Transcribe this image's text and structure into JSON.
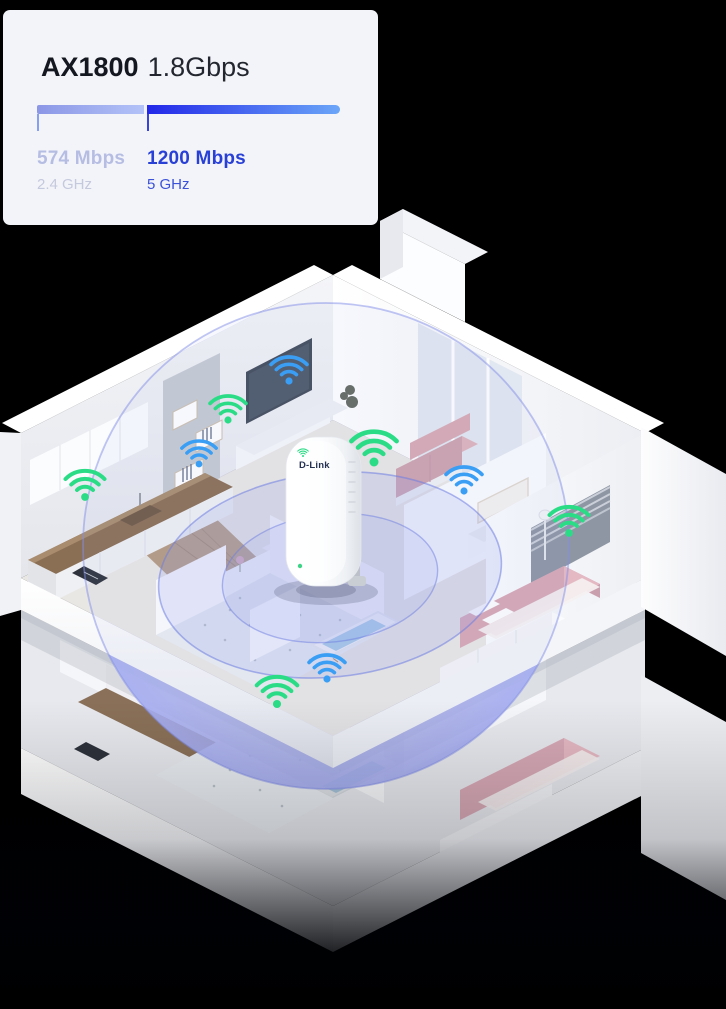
{
  "card": {
    "model": "AX1800",
    "speed": "1.8Gbps",
    "bands": [
      {
        "speed": "574 Mbps",
        "freq": "2.4 GHz"
      },
      {
        "speed": "1200 Mbps",
        "freq": "5 GHz"
      }
    ]
  },
  "device": {
    "brand": "D-Link",
    "indicator_icon": "wifi-signal-green",
    "status_led": "green"
  },
  "icons": {
    "strong_signal": "wifi-icon-green",
    "normal_signal": "wifi-icon-blue"
  },
  "colors": {
    "background": "#000000",
    "card_bg": "#f3f4fa",
    "title": "#14171f",
    "band1_bar_start": "#8b97e6",
    "band1_bar_end": "#b3c2f8",
    "band2_bar_start": "#2227e8",
    "band2_bar_end": "#6ba6f8",
    "band1_label": "#b6bde3",
    "band1_sub": "#c5c9dd",
    "band2_label": "#2840d6",
    "band2_sub": "#3c52d8",
    "wifi_green": "#2bdc86",
    "wifi_blue": "#3b9ef5",
    "coverage": "#a6aeea",
    "device_brand": "#253252"
  }
}
